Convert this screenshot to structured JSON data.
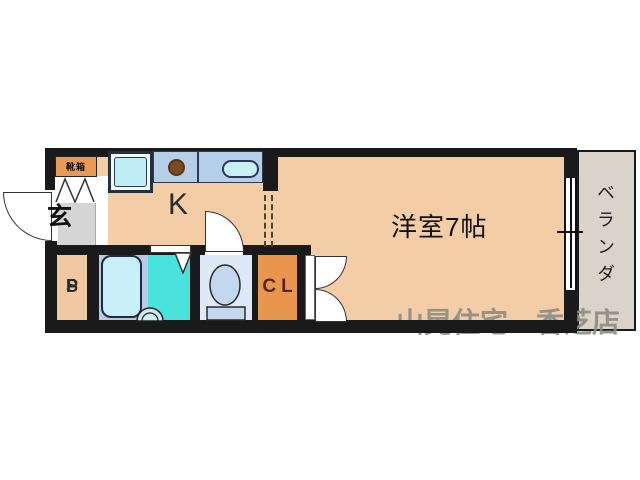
{
  "floorplan": {
    "rooms": {
      "entrance_label": "玄",
      "shoe_box_label": "靴箱",
      "kitchen_label": "K",
      "main_room_label": "洋室7帖",
      "veranda_label": "ベランダ",
      "closet_label": "CL",
      "pipe_space_chars": [
        "P",
        "S"
      ]
    },
    "watermark_text": "山晃住宅　香芝店",
    "colors": {
      "wall": "#1a1a1a",
      "floor": "#f2cda6",
      "entrance_floor": "#d5d5d5",
      "shoe_box": "#e99a55",
      "closet": "#e8964e",
      "kitchen_counter": "#b5cfe9",
      "bath_floor": "#b9c9e3",
      "bathtub": "#c8eef8",
      "shower_floor": "#49e2dd",
      "toilet_floor": "#dde9f6",
      "veranda_floor": "#d9d3c9",
      "watermark": "#8e8c85"
    }
  }
}
